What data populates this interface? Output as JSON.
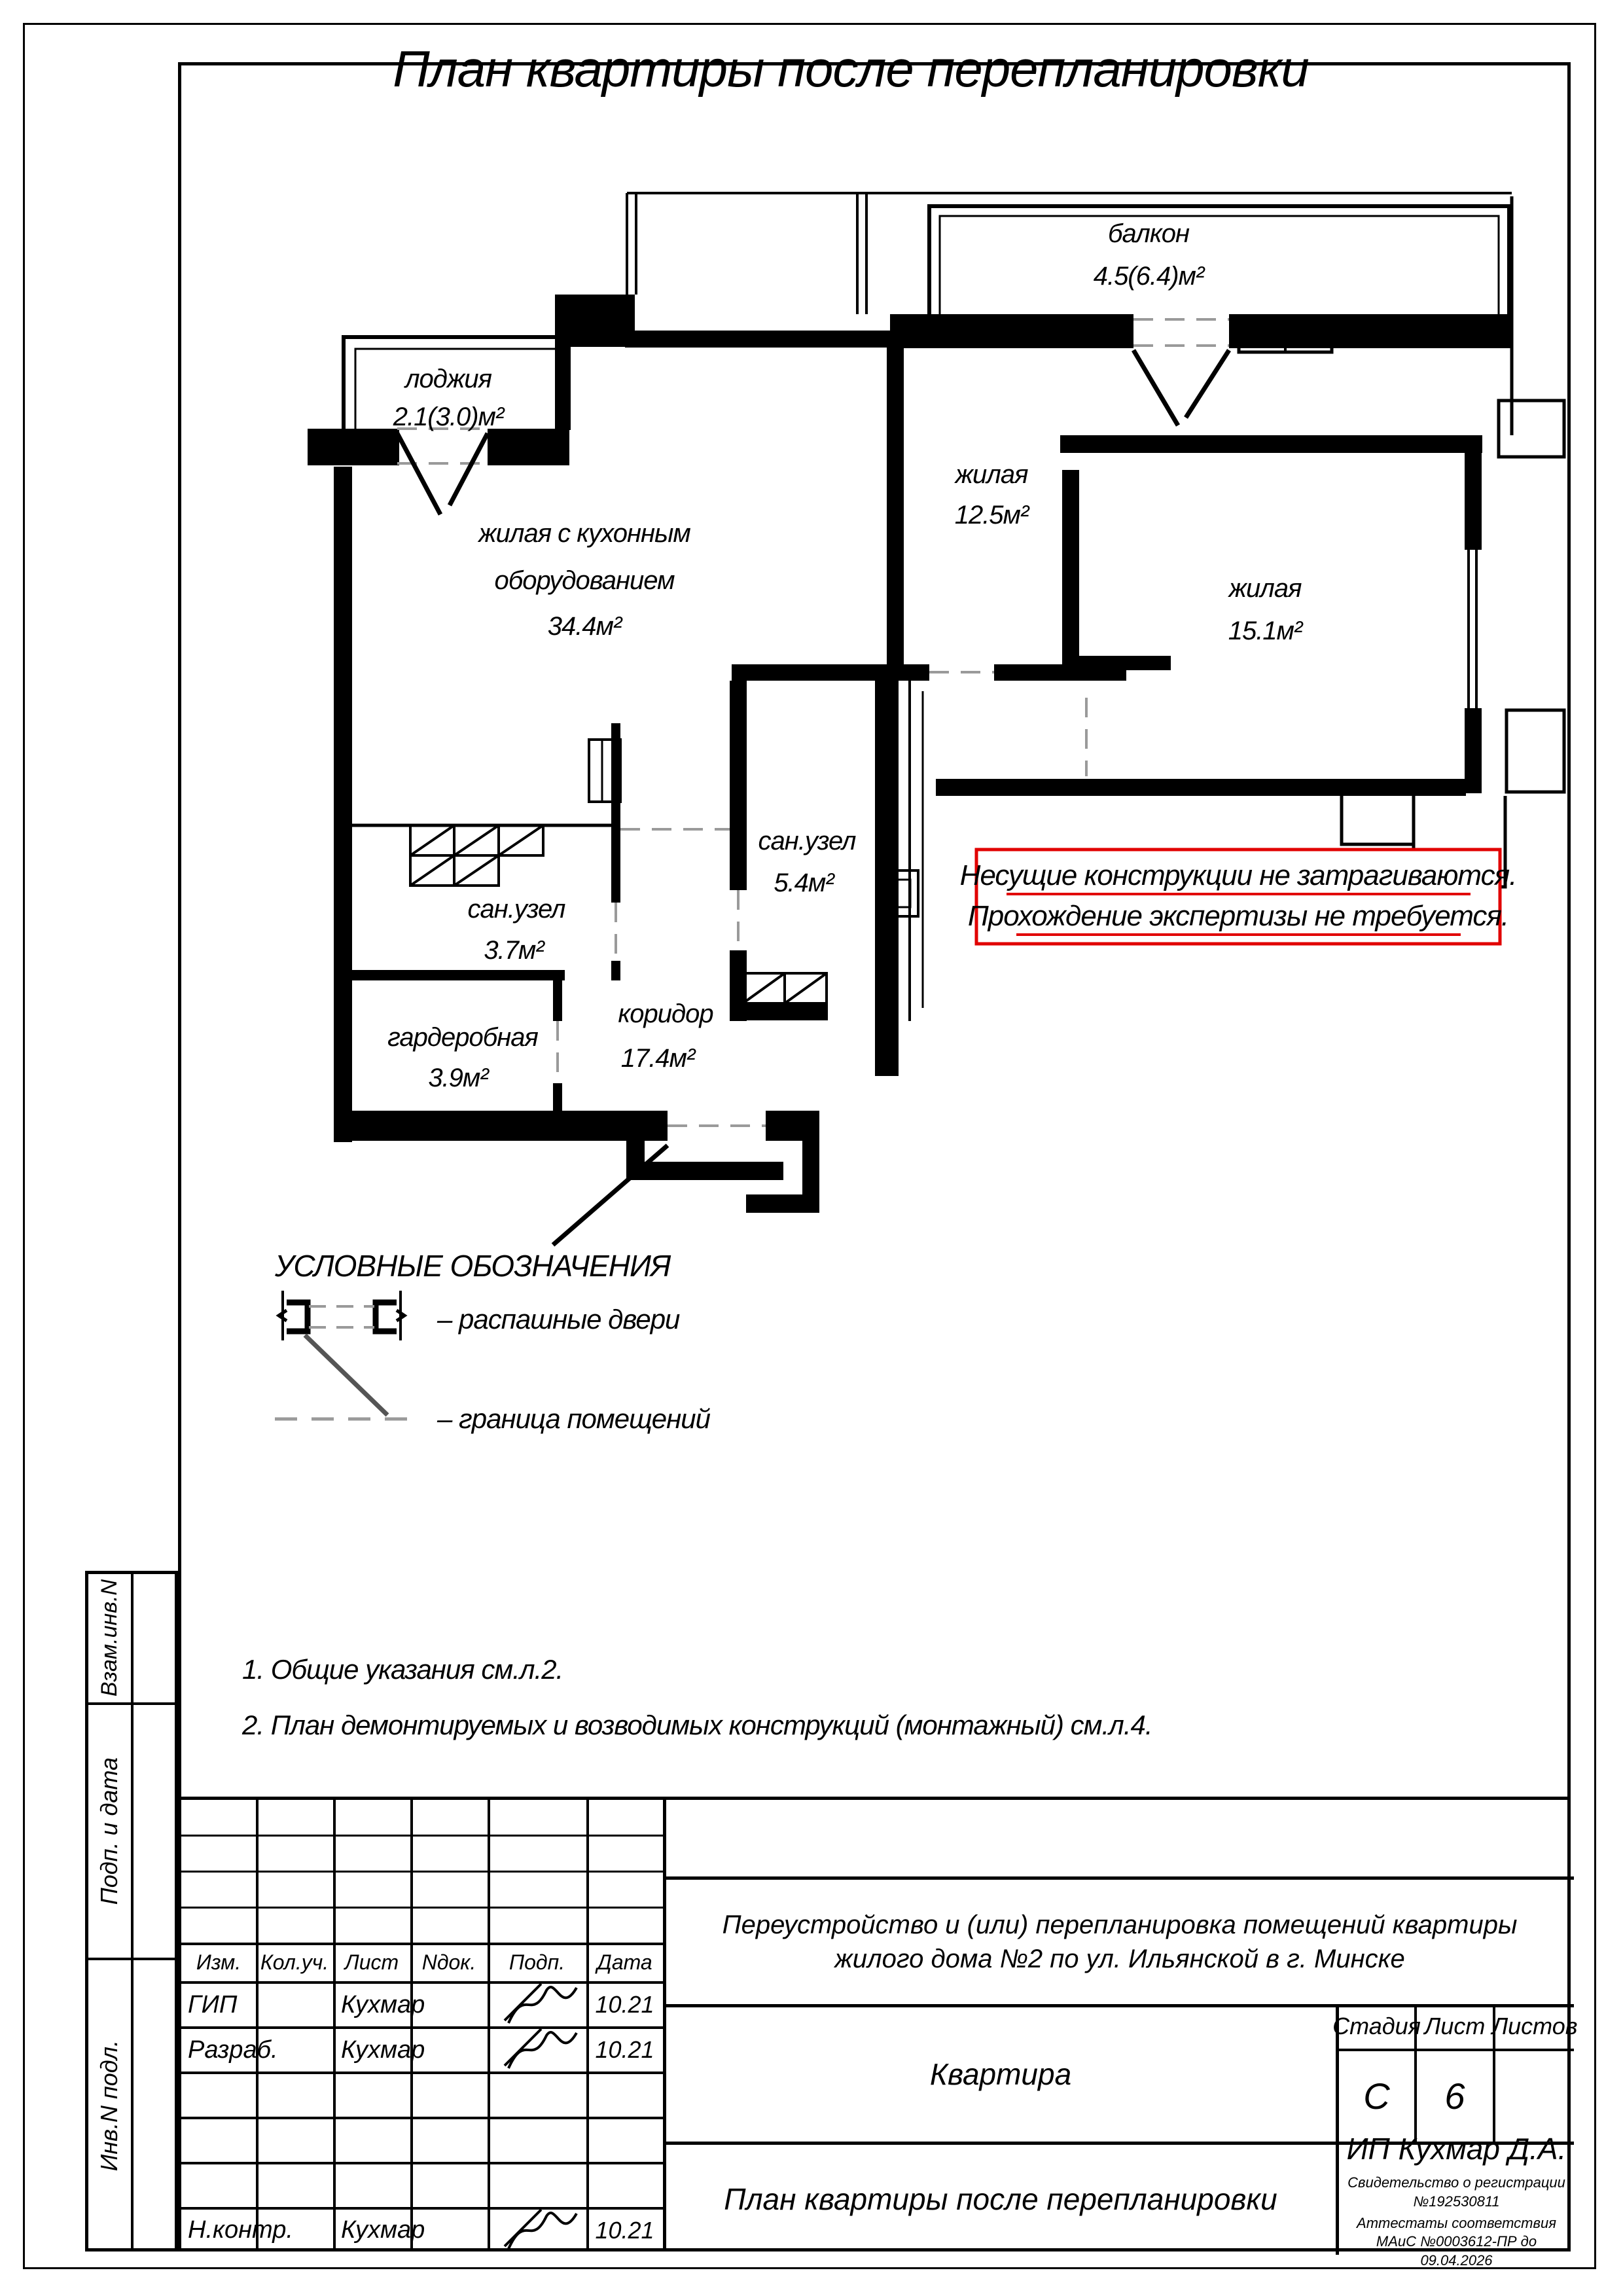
{
  "page": {
    "title": "План квартиры после перепланировки"
  },
  "plan": {
    "rooms": {
      "balkon": {
        "name": "балкон",
        "area": "4.5(6.4)м²"
      },
      "lodzhiya": {
        "name": "лоджия",
        "area": "2.1(3.0)м²"
      },
      "zhilaya1": {
        "name": "жилая",
        "area": "12.5м²"
      },
      "zhilaya2": {
        "name": "жилая",
        "area": "15.1м²"
      },
      "kitchen": {
        "line1": "жилая с кухонным",
        "line2": "оборудованием",
        "area": "34.4м²"
      },
      "sanuzel1": {
        "name": "сан.узел",
        "area": "5.4м²"
      },
      "sanuzel2": {
        "name": "сан.узел",
        "area": "3.7м²"
      },
      "garderob": {
        "name": "гардеробная",
        "area": "3.9м²"
      },
      "koridor": {
        "name": "коридор",
        "area": "17.4м²"
      }
    },
    "note_box": {
      "line1": "Несущие конструкции не затрагиваются.",
      "line2": "Прохождение экспертизы не требуется.",
      "color": "#e10000"
    }
  },
  "legend": {
    "title": "УСЛОВНЫЕ ОБОЗНАЧЕНИЯ",
    "doors_label": "– распашные двери",
    "boundary_label": "– граница помещений"
  },
  "notes": {
    "n1": "1. Общие указания см.л.2.",
    "n2": "2. План демонтируемых и возводимых конструкций (монтажный) см.л.4."
  },
  "sidebar": {
    "label1": "Взам.инв.N",
    "label2": "Подп. и дата",
    "label3": "Инв.N подл."
  },
  "titleblock": {
    "header_cols": [
      "Изм.",
      "Кол.уч.",
      "Лист",
      "Nдок.",
      "Подп.",
      "Дата"
    ],
    "rows": [
      {
        "role": "ГИП",
        "name": "Кухмар",
        "date": "10.21"
      },
      {
        "role": "Разраб.",
        "name": "Кухмар",
        "date": "10.21"
      },
      {
        "role": "Н.контр.",
        "name": "Кухмар",
        "date": "10.21"
      }
    ],
    "project_line1": "Переустройство и (или) перепланировка помещений квартиры",
    "project_line2": "жилого дома №2 по ул. Ильянской в г. Минске",
    "object": "Квартира",
    "stage_label": "Стадия",
    "sheet_label": "Лист",
    "sheets_label": "Листов",
    "stage": "С",
    "sheet": "6",
    "doc_title": "План квартиры после перепланировки",
    "company": "ИП Кухмар Д.А.",
    "cert1": "Свидетельство о регистрации №192530811",
    "cert2": "Аттестаты соответствия МАиС №0003612-ПР до 09.04.2026"
  }
}
